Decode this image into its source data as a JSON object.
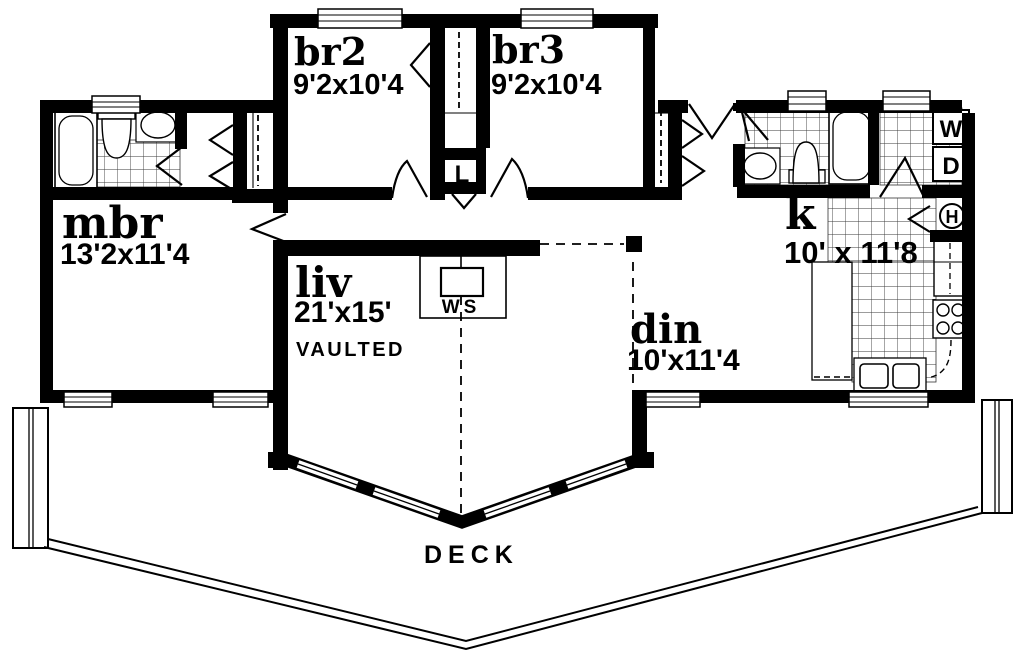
{
  "plan": {
    "rooms": [
      {
        "id": "mbr",
        "label": "mbr",
        "dims": "13'2x11'4"
      },
      {
        "id": "br2",
        "label": "br2",
        "dims": "9'2x10'4"
      },
      {
        "id": "br3",
        "label": "br3",
        "dims": "9'2x10'4"
      },
      {
        "id": "liv",
        "label": "liv",
        "dims": "21'x15'",
        "note": "VAULTED"
      },
      {
        "id": "din",
        "label": "din",
        "dims": "10'x11'4"
      },
      {
        "id": "kitchen",
        "label": "k",
        "dims": "10' x 11'8"
      },
      {
        "id": "deck",
        "label": "DECK"
      }
    ],
    "markers": {
      "washer": "W",
      "dryer": "D",
      "water_heater": "H",
      "linen": "L",
      "wood_stove": "WS"
    },
    "colors": {
      "ink": "#000000",
      "paper": "#ffffff"
    }
  }
}
